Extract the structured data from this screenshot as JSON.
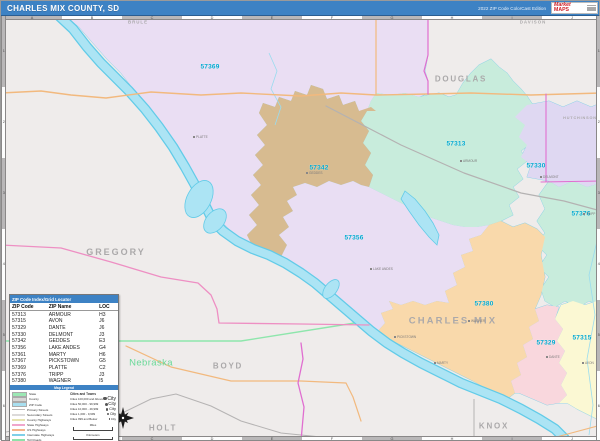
{
  "header": {
    "title": "CHARLES MIX COUNTY, SD",
    "edition": "2022 ZIP Code ColorCast Edition",
    "logo": {
      "top": "Market",
      "bottom": "MAPS"
    }
  },
  "map": {
    "zip_labels": [
      {
        "text": "57369",
        "x": 209,
        "y": 52
      },
      {
        "text": "57342",
        "x": 318,
        "y": 153
      },
      {
        "text": "57313",
        "x": 455,
        "y": 129
      },
      {
        "text": "57330",
        "x": 535,
        "y": 151
      },
      {
        "text": "57376",
        "x": 580,
        "y": 199
      },
      {
        "text": "57356",
        "x": 353,
        "y": 223
      },
      {
        "text": "57380",
        "x": 483,
        "y": 289
      },
      {
        "text": "57329",
        "x": 545,
        "y": 328
      },
      {
        "text": "57315",
        "x": 581,
        "y": 323
      }
    ],
    "county_labels": [
      {
        "text": "BRULE",
        "x": 137,
        "y": 7,
        "size": 4.4
      },
      {
        "text": "DAVISON",
        "x": 532,
        "y": 7,
        "size": 4.4
      },
      {
        "text": "DOUGLAS",
        "x": 460,
        "y": 64,
        "size": 8
      },
      {
        "text": "HUTCHINSON",
        "x": 579,
        "y": 103,
        "size": 3.8
      },
      {
        "text": "GREGORY",
        "x": 115,
        "y": 237,
        "size": 9
      },
      {
        "text": "CHARLES MIX",
        "x": 452,
        "y": 306,
        "size": 9.5
      },
      {
        "text": "BOYD",
        "x": 227,
        "y": 351,
        "size": 8
      },
      {
        "text": "HOLT",
        "x": 162,
        "y": 413,
        "size": 8
      },
      {
        "text": "KNOX",
        "x": 493,
        "y": 411,
        "size": 8
      }
    ],
    "state_label": {
      "text": "Nebraska",
      "x": 150,
      "y": 348
    },
    "towns": [
      {
        "name": "PLATTE",
        "x": 193,
        "y": 114
      },
      {
        "name": "GEDDES",
        "x": 306,
        "y": 150
      },
      {
        "name": "ARMOUR",
        "x": 460,
        "y": 138
      },
      {
        "name": "DELMONT",
        "x": 540,
        "y": 154
      },
      {
        "name": "TRIPP",
        "x": 583,
        "y": 191
      },
      {
        "name": "LAKE ANDES",
        "x": 370,
        "y": 246
      },
      {
        "name": "WAGNER",
        "x": 468,
        "y": 298
      },
      {
        "name": "PICKSTOWN",
        "x": 394,
        "y": 314
      },
      {
        "name": "MARTY",
        "x": 434,
        "y": 340
      },
      {
        "name": "DANTE",
        "x": 546,
        "y": 334
      },
      {
        "name": "AVON",
        "x": 582,
        "y": 340
      }
    ],
    "grid": {
      "cols": [
        "A",
        "B",
        "C",
        "D",
        "E",
        "F",
        "G",
        "H",
        "I",
        "J"
      ],
      "rows": [
        "1",
        "2",
        "3",
        "4",
        "5",
        "6"
      ]
    },
    "colors": {
      "header_blue": "#3d82c4",
      "zip_label": "#00a9d0",
      "water": "#ace4f4",
      "water_edge": "#62cbe8",
      "state_line": "#8ee6ac",
      "outside": "#efeceb",
      "regions": {
        "57369": "#eadef3",
        "57313": "#c8ecdc",
        "57330": "#dfd8f2",
        "57376": "#c8ecdc",
        "57342": "#d7bb90",
        "57356": "#e9def3",
        "57380": "#f9d9ab",
        "57329": "#f9d7dd",
        "57315": "#fbf8d3"
      }
    }
  },
  "zip_index": {
    "title": "ZIP Code Index/Grid Locator",
    "columns": [
      "ZIP Code",
      "ZIP Name",
      "LOC"
    ],
    "rows": [
      [
        "57313",
        "ARMOUR",
        "H3"
      ],
      [
        "57315",
        "AVON",
        "J6"
      ],
      [
        "57329",
        "DANTE",
        "J6"
      ],
      [
        "57330",
        "DELMONT",
        "J3"
      ],
      [
        "57342",
        "GEDDES",
        "E3"
      ],
      [
        "57356",
        "LAKE ANDES",
        "G4"
      ],
      [
        "57361",
        "MARTY",
        "H6"
      ],
      [
        "57367",
        "PICKSTOWN",
        "G5"
      ],
      [
        "57369",
        "PLATTE",
        "C2"
      ],
      [
        "57376",
        "TRIPP",
        "J3"
      ],
      [
        "57380",
        "WAGNER",
        "I5"
      ]
    ]
  },
  "legend": {
    "bar_title": "Map Legend",
    "items": [
      {
        "label": "State",
        "swatch": "#9be8b4",
        "type": "box"
      },
      {
        "label": "County",
        "swatch": "#d8d6d6",
        "type": "box"
      },
      {
        "label": "ZIP Code",
        "swatch": "#a8dff0",
        "type": "box"
      },
      {
        "label": "Primary Streets",
        "swatch": "#bcbaba",
        "type": "line"
      },
      {
        "label": "Secondary Streets",
        "swatch": "#dcdada",
        "type": "line"
      },
      {
        "label": "County Highways",
        "swatch": "#e6e2b0",
        "type": "line"
      },
      {
        "label": "State Highways",
        "swatch": "#f0a6cc",
        "type": "line"
      },
      {
        "label": "US Highways",
        "swatch": "#f5b48a",
        "type": "line"
      },
      {
        "label": "Interstate Highways",
        "swatch": "#7fd0e8",
        "type": "line"
      },
      {
        "label": "Toll Roads",
        "swatch": "#8fe0a8",
        "type": "line"
      }
    ],
    "cities_header": "Cities and Towns",
    "city_classes": [
      {
        "label": "Cities 100,000 and Above",
        "sample": "City"
      },
      {
        "label": "Cities 50,000 - 99,999",
        "sample": "City"
      },
      {
        "label": "Cities 10,000 - 49,999",
        "sample": "City"
      },
      {
        "label": "Cities 1,000 - 9,999",
        "sample": "City"
      },
      {
        "label": "Cities 999 and Below",
        "sample": "City"
      }
    ],
    "scales": [
      {
        "label": "Miles"
      },
      {
        "label": "Kilometers"
      }
    ]
  }
}
